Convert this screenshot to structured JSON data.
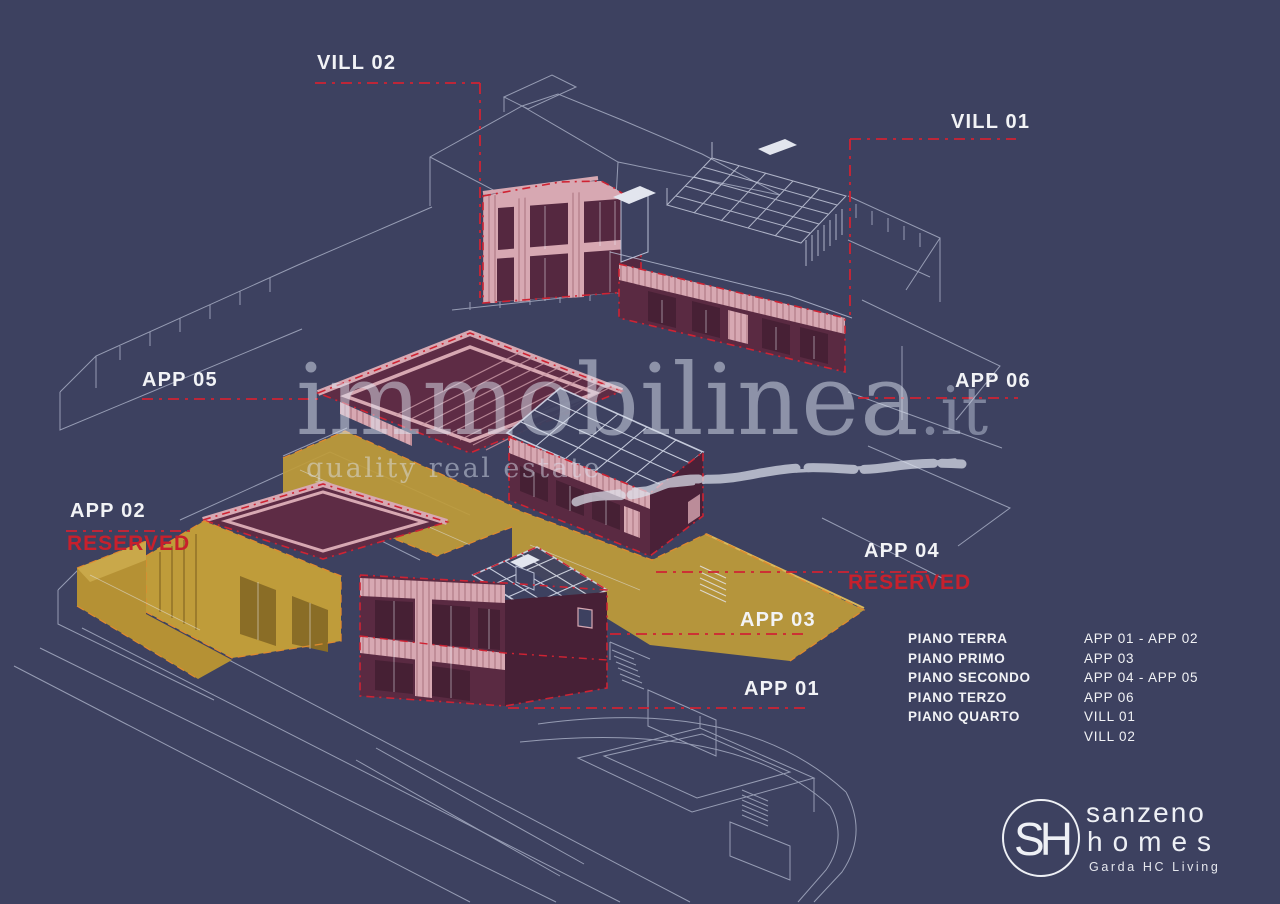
{
  "palette": {
    "background": "#3d4160",
    "wireframe": "#b9bfd4",
    "highlight_maroon": "#5a2a42",
    "highlight_pink": "#d7a8b2",
    "reserved_yellow": "#bf9c3a",
    "dashed_red": "#cf2333",
    "reserved_text_red": "#c8202c",
    "label_white": "#f2f3f6"
  },
  "units": {
    "vill02": {
      "label": "VILL 02"
    },
    "vill01": {
      "label": "VILL 01"
    },
    "app05": {
      "label": "APP 05"
    },
    "app06": {
      "label": "APP 06"
    },
    "app02": {
      "label": "APP 02",
      "status": "RESERVED"
    },
    "app04": {
      "label": "APP 04",
      "status": "RESERVED"
    },
    "app03": {
      "label": "APP 03"
    },
    "app01": {
      "label": "APP 01"
    }
  },
  "watermark": {
    "brand": "immobilinea",
    "tld": ".it",
    "tagline": "quality real estate"
  },
  "legend": {
    "rows": [
      {
        "floor": "PIANO TERRA",
        "units": "APP 01 - APP 02"
      },
      {
        "floor": "PIANO PRIMO",
        "units": "APP 03"
      },
      {
        "floor": "PIANO SECONDO",
        "units": "APP 04 - APP 05"
      },
      {
        "floor": "PIANO TERZO",
        "units": "APP 06"
      },
      {
        "floor": "PIANO QUARTO",
        "units": "VILL 01"
      },
      {
        "floor": "",
        "units": "VILL 02"
      }
    ]
  },
  "logo": {
    "monogram": "SH",
    "line1": "sanzeno",
    "line2": "homes",
    "tagline": "Garda HC Living"
  }
}
